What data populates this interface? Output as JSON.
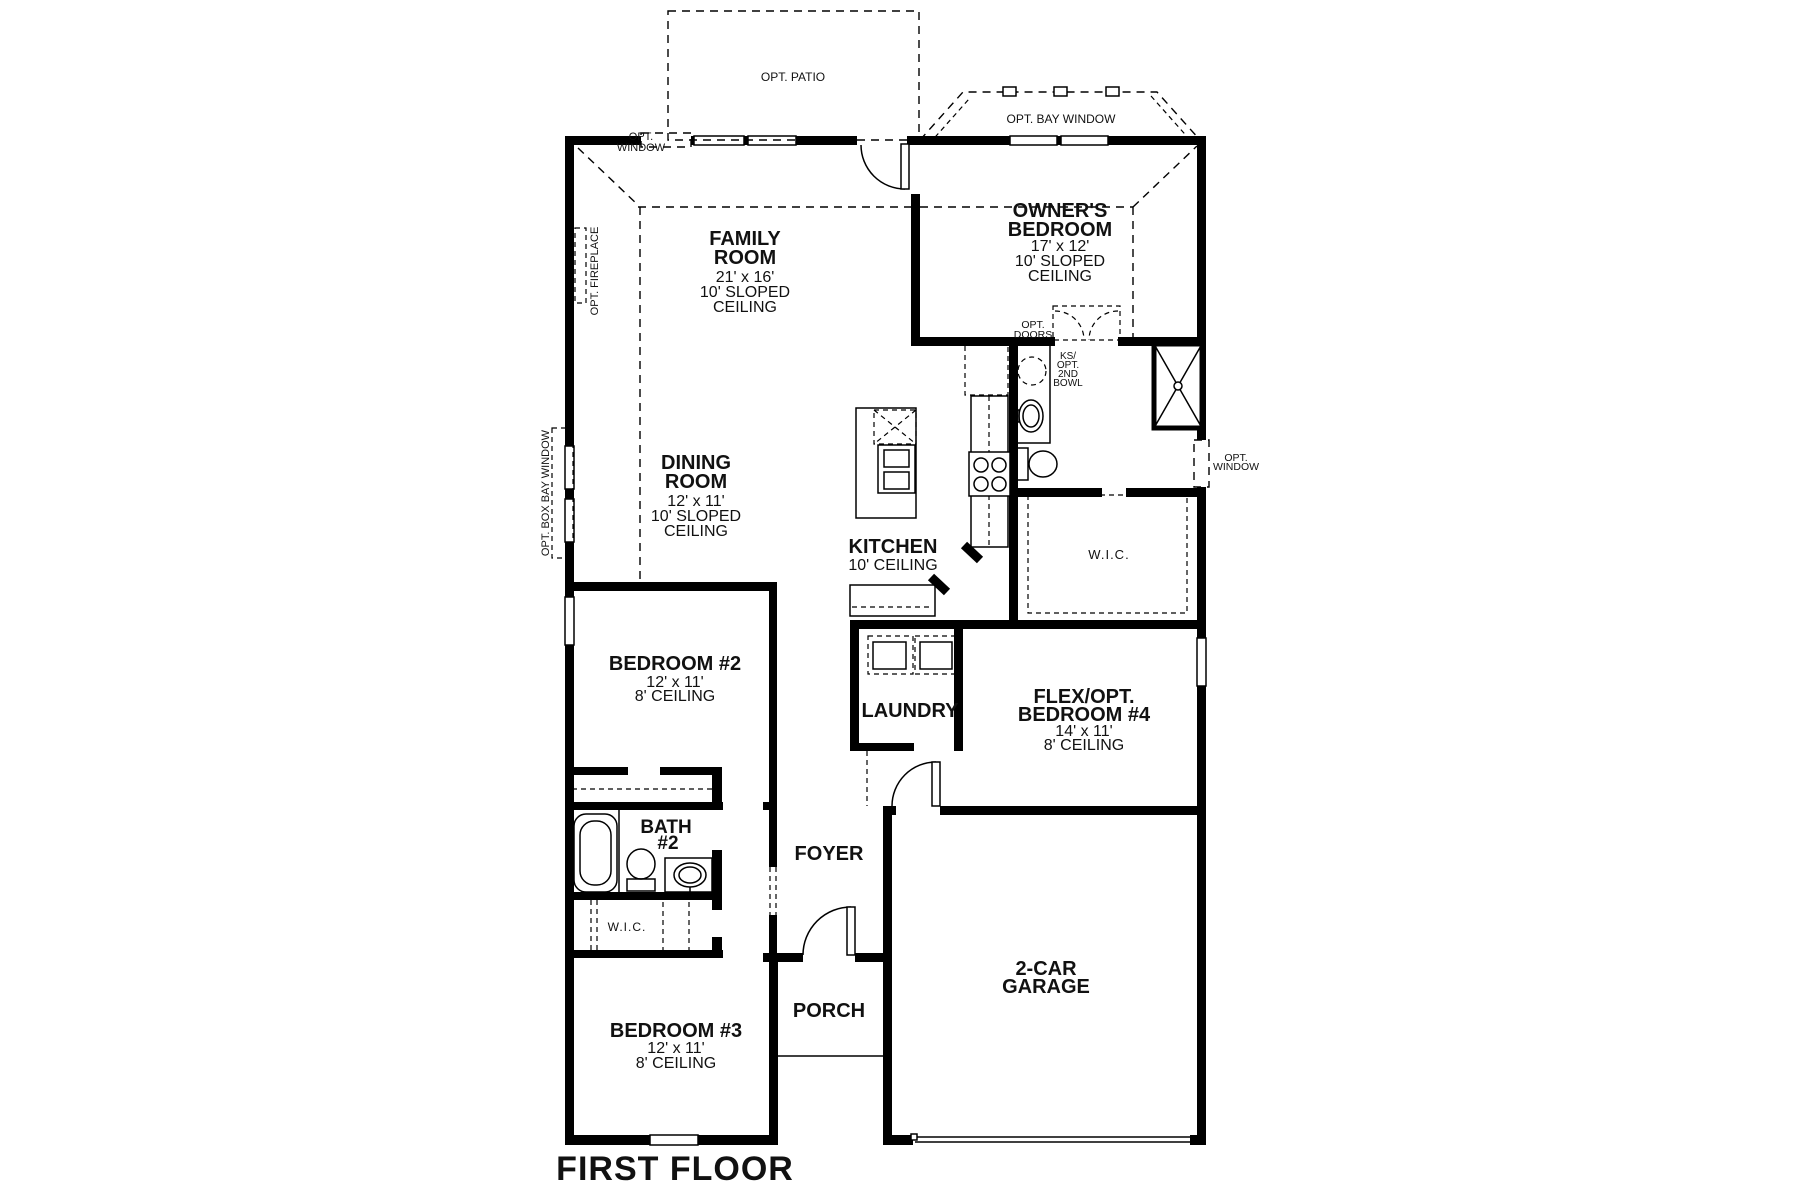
{
  "title": "FIRST FLOOR",
  "rooms": {
    "family_room": {
      "lines": [
        "FAMILY",
        "ROOM",
        "21' x 16'",
        "10' SLOPED",
        "CEILING"
      ]
    },
    "owners_bedroom": {
      "lines": [
        "OWNER'S",
        "BEDROOM",
        "17' x 12'",
        "10' SLOPED",
        "CEILING"
      ]
    },
    "dining_room": {
      "lines": [
        "DINING",
        "ROOM",
        "12' x 11'",
        "10' SLOPED",
        "CEILING"
      ]
    },
    "kitchen": {
      "lines": [
        "KITCHEN",
        "10' CEILING"
      ]
    },
    "bedroom_2": {
      "lines": [
        "BEDROOM #2",
        "12' x 11'",
        "8' CEILING"
      ]
    },
    "bedroom_3": {
      "lines": [
        "BEDROOM #3",
        "12' x 11'",
        "8' CEILING"
      ]
    },
    "flex_bedroom_4": {
      "lines": [
        "FLEX/OPT.",
        "BEDROOM #4",
        "14' x 11'",
        "8' CEILING"
      ]
    },
    "bath_2": {
      "lines": [
        "BATH",
        "#2"
      ]
    },
    "laundry": {
      "label": "LAUNDRY"
    },
    "foyer": {
      "label": "FOYER"
    },
    "porch": {
      "label": "PORCH"
    },
    "garage": {
      "lines": [
        "2-CAR",
        "GARAGE"
      ]
    },
    "wic_owner": {
      "label": "W.I.C."
    },
    "wic_bedroom3": {
      "label": "W.I.C."
    }
  },
  "annotations": {
    "opt_patio": "OPT. PATIO",
    "opt_window_top": {
      "lines": [
        "OPT.",
        "WINDOW"
      ]
    },
    "opt_bay_window": "OPT. BAY WINDOW",
    "opt_fireplace": "OPT. FIREPLACE",
    "opt_box_bay_window": "OPT. BOX BAY WINDOW",
    "opt_doors": {
      "lines": [
        "OPT.",
        "DOORS"
      ]
    },
    "opt_window_right": {
      "lines": [
        "OPT.",
        "WINDOW"
      ]
    },
    "ks_opt_2nd_bowl": {
      "lines": [
        "KS/",
        "OPT.",
        "2ND",
        "BOWL"
      ]
    }
  },
  "colors": {
    "wall": "#000000",
    "background": "#ffffff",
    "text": "#111111"
  }
}
